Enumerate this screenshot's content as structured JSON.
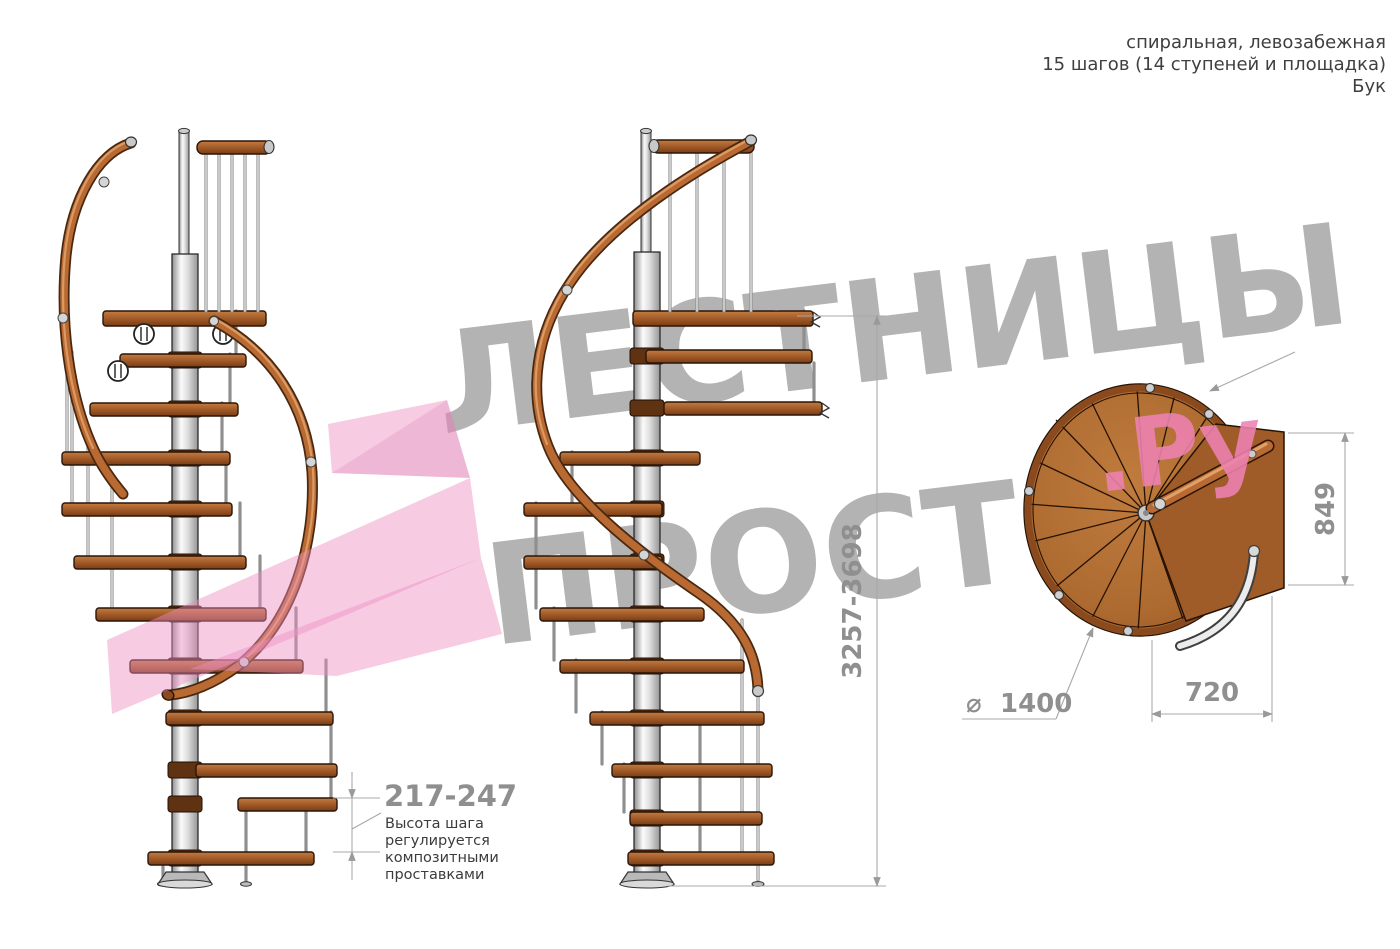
{
  "header": {
    "line1": "спиральная, левозабежная",
    "line2": "15 шагов (14 ступеней и площадка)",
    "line3": "Бук"
  },
  "watermark": {
    "line1": "ЛЕСТНИЦЫ",
    "line2": "ПРОСТО",
    "suffix": ".Ру"
  },
  "dimensions": {
    "total_height": "3257-3698",
    "step_height": "217-247",
    "landing_depth": "849",
    "landing_width": "720",
    "diameter_symbol": "⌀",
    "diameter": "1400"
  },
  "annotation": {
    "line1": "Высота шага",
    "line2": "регулируется",
    "line3": "композитными",
    "line4": "проставками"
  },
  "colors": {
    "wood": "#a05a28",
    "handrail_copper": "#b96a33",
    "pole_steel": "#d9d9d9",
    "dimension_gray": "#8f8f8f",
    "watermark_gray": "#a6a6a6",
    "watermark_pink": "#ee82b2"
  }
}
